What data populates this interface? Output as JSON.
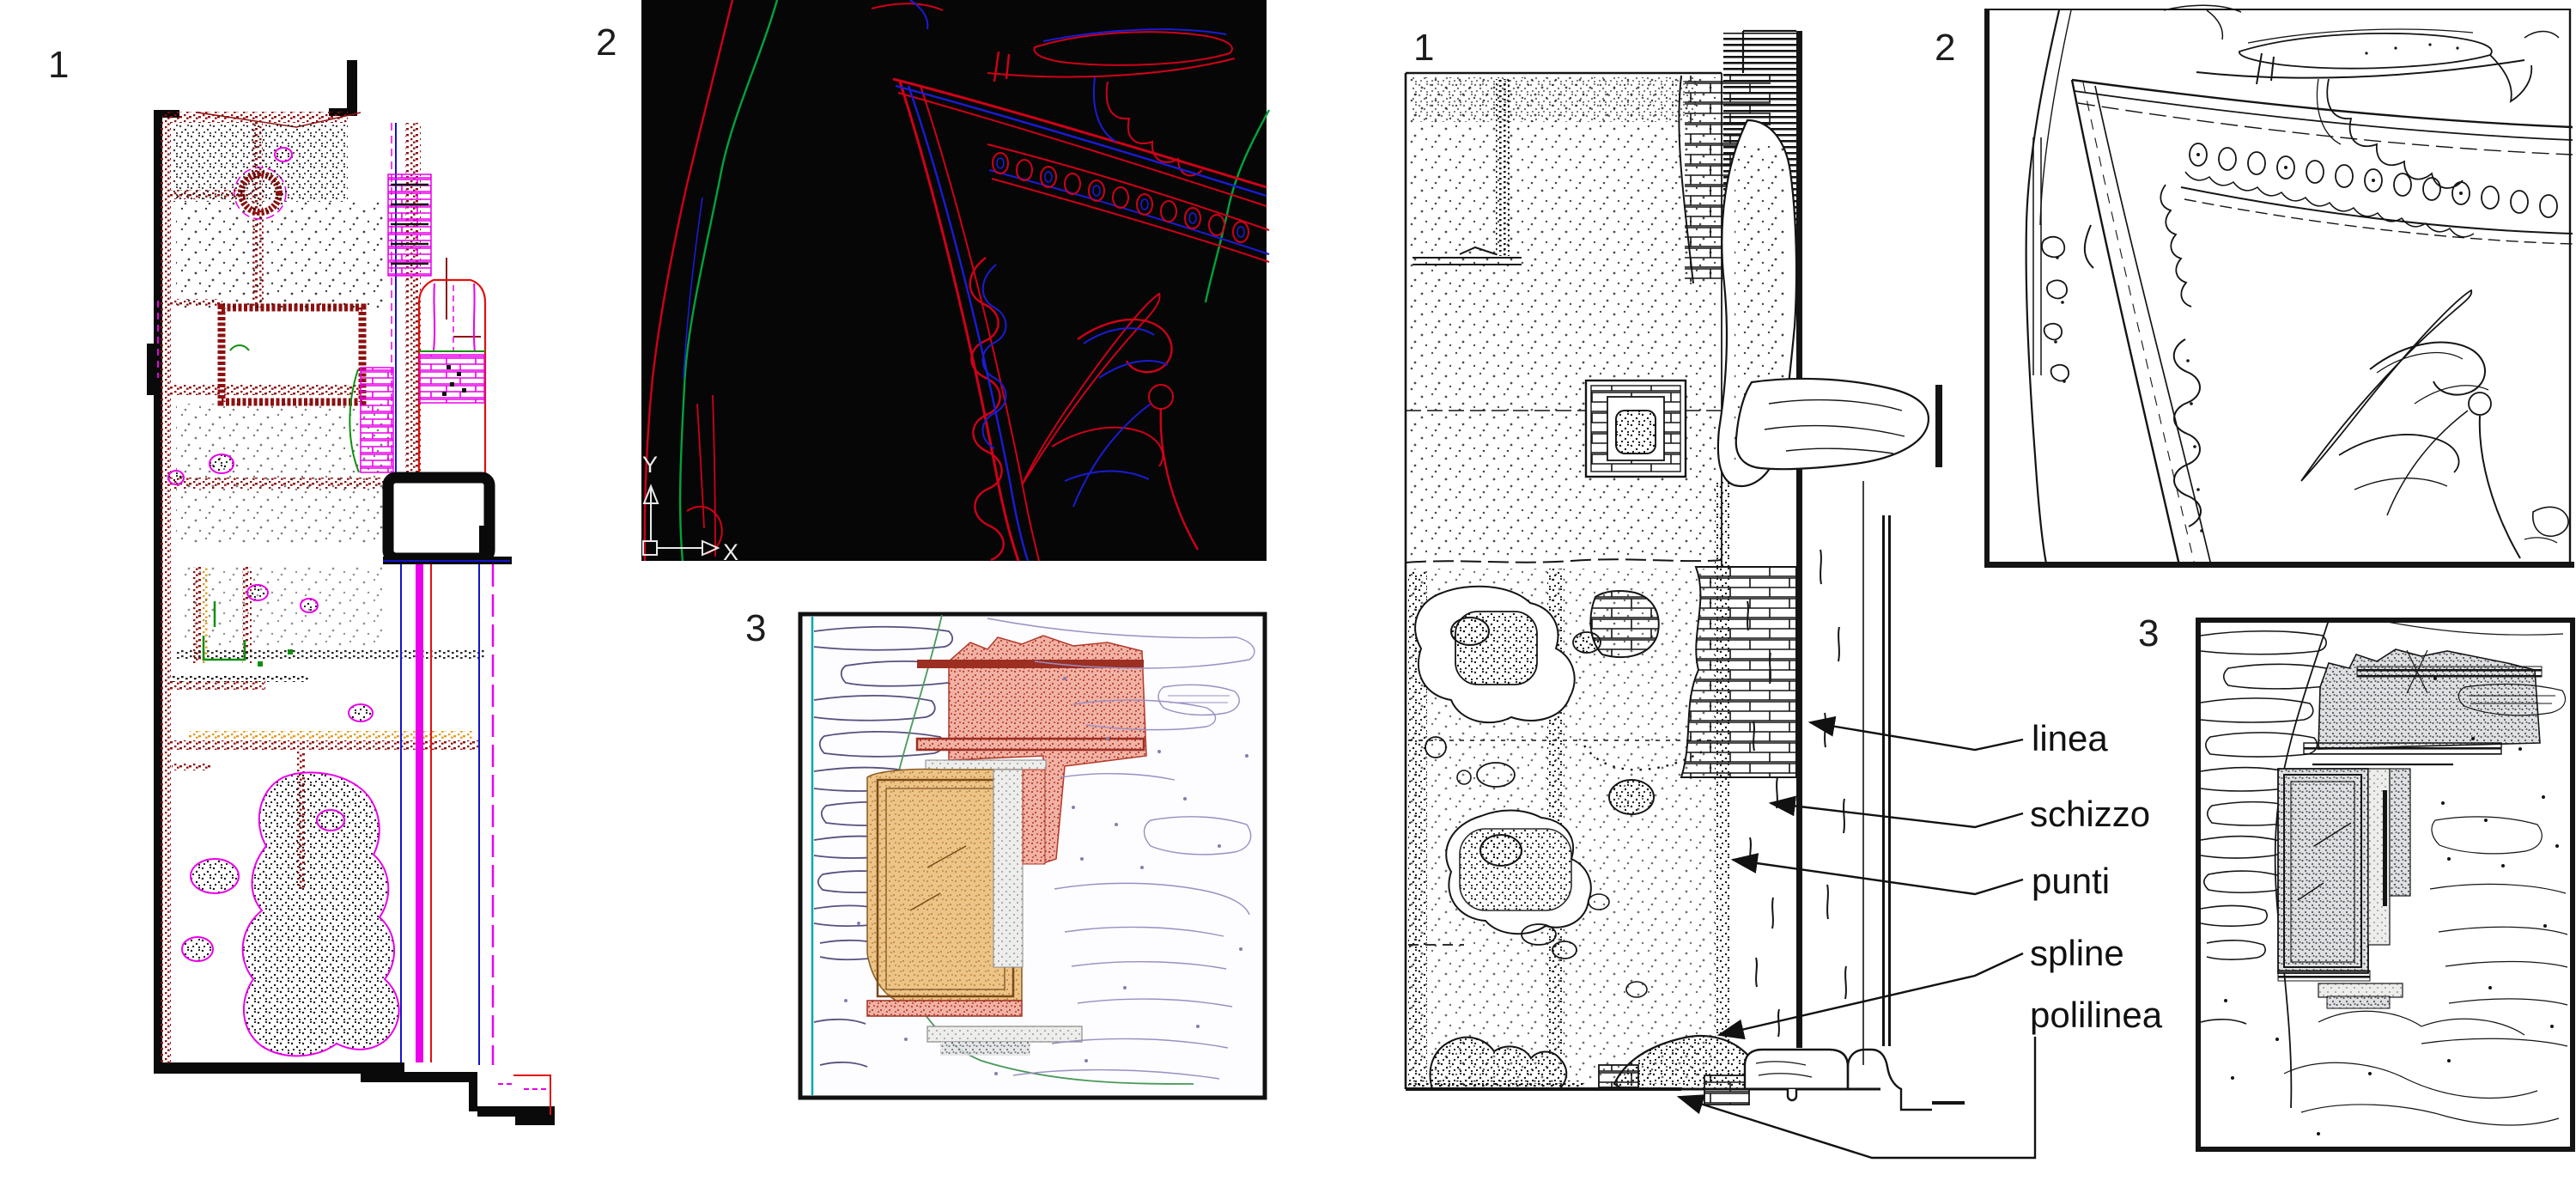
{
  "left_group": {
    "panel1_label": "1",
    "panel2_label": "2",
    "panel3_label": "3"
  },
  "right_group": {
    "panel1_label": "1",
    "panel2_label": "2",
    "panel3_label": "3"
  },
  "annotations": {
    "linea": "linea",
    "schizzo": "schizzo",
    "punti": "punti",
    "spline": "spline",
    "polilinea": "polilinea"
  },
  "ucs_icon": {
    "y_label": "Y",
    "x_label": "X"
  },
  "colors": {
    "cad_screen_background": "#060606",
    "cad_red": "#d00018",
    "cad_blue": "#1b1bd6",
    "cad_green": "#00a33c",
    "ucs_white": "#e9e9e9",
    "magenta": "#ea00ea",
    "dark_red_speckle": "#8e1010",
    "orange_speckle": "#df9b1e",
    "detail_green": "#0f8f0f",
    "detail_blue": "#1414cc",
    "detail_red": "#e01010",
    "tan_fill": "#ecc488",
    "red_hatch_fill": "#efb3a6",
    "gray_band": "#dfe0e2",
    "teal": "#00a8ab",
    "slate_stone": "#56507e",
    "lavender": "#9a8ec2",
    "ink_black": "#141414"
  }
}
